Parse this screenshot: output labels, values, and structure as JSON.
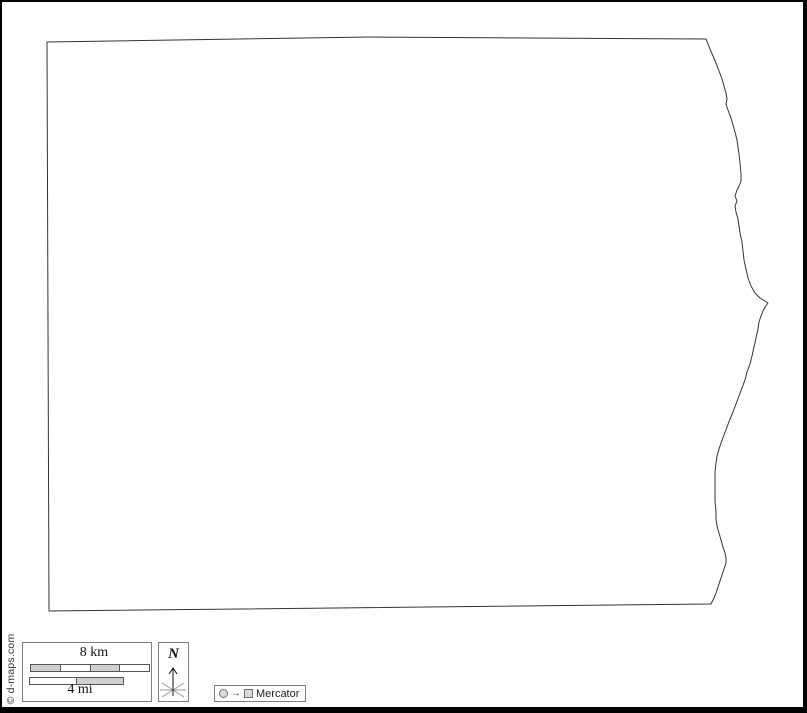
{
  "attribution": "© d-maps.com",
  "scale_bar": {
    "km_label": "8 km",
    "mi_label": "4 mi"
  },
  "compass": {
    "north_label": "N"
  },
  "projection": {
    "arrow_glyph": "→",
    "label": "Mercator"
  },
  "colors": {
    "frame": "#000000",
    "map_outline": "#333333",
    "box_border": "#808080",
    "bar_gray": "#d0d0d0",
    "bar_white": "#ffffff",
    "symbol_fill": "#d9d9d9"
  }
}
